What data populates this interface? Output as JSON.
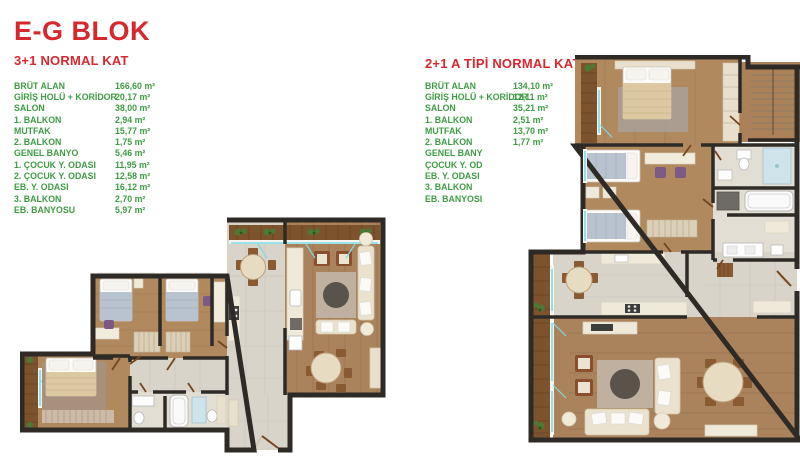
{
  "header": {
    "title": "E-G BLOK"
  },
  "colors": {
    "red": "#d7282e",
    "green": "#3f9c45"
  },
  "plans": [
    {
      "title": "3+1 NORMAL KAT",
      "specs": [
        {
          "label": "BRÜT ALAN",
          "value": "166,60 m²"
        },
        {
          "label": "GİRİŞ HOLÜ + KORİDOR",
          "value": "20,17 m²"
        },
        {
          "label": "SALON",
          "value": "38,00 m²"
        },
        {
          "label": "1. BALKON",
          "value": "2,94 m²"
        },
        {
          "label": "MUTFAK",
          "value": "15,77 m²"
        },
        {
          "label": "2. BALKON",
          "value": "1,75 m²"
        },
        {
          "label": "GENEL BANYO",
          "value": "5,46 m²"
        },
        {
          "label": "1. ÇOCUK Y. ODASI",
          "value": "11,95 m²"
        },
        {
          "label": "2. ÇOCUK Y. ODASI",
          "value": "12,58 m²"
        },
        {
          "label": "EB. Y. ODASI",
          "value": "16,12 m²"
        },
        {
          "label": "3. BALKON",
          "value": "2,70 m²"
        },
        {
          "label": "EB. BANYOSU",
          "value": "5,97 m²"
        }
      ]
    },
    {
      "title": "2+1 A TİPİ NORMAL KAT",
      "specs": [
        {
          "label": "BRÜT ALAN",
          "value": "134,10 m²"
        },
        {
          "label": "GİRİŞ HOLÜ + KORİDOR",
          "value": "12,11 m²"
        },
        {
          "label": "SALON",
          "value": "35,21 m²"
        },
        {
          "label": "1. BALKON",
          "value": "2,51 m²"
        },
        {
          "label": "MUTFAK",
          "value": "13,70 m²"
        },
        {
          "label": "2. BALKON",
          "value": "1,77 m²"
        },
        {
          "label": "GENEL BANY",
          "value": ""
        },
        {
          "label": "ÇOCUK Y. OD",
          "value": ""
        },
        {
          "label": "EB. Y. ODASI",
          "value": ""
        },
        {
          "label": "3. BALKON",
          "value": ""
        },
        {
          "label": "EB. BANYOSI",
          "value": ""
        }
      ]
    }
  ]
}
